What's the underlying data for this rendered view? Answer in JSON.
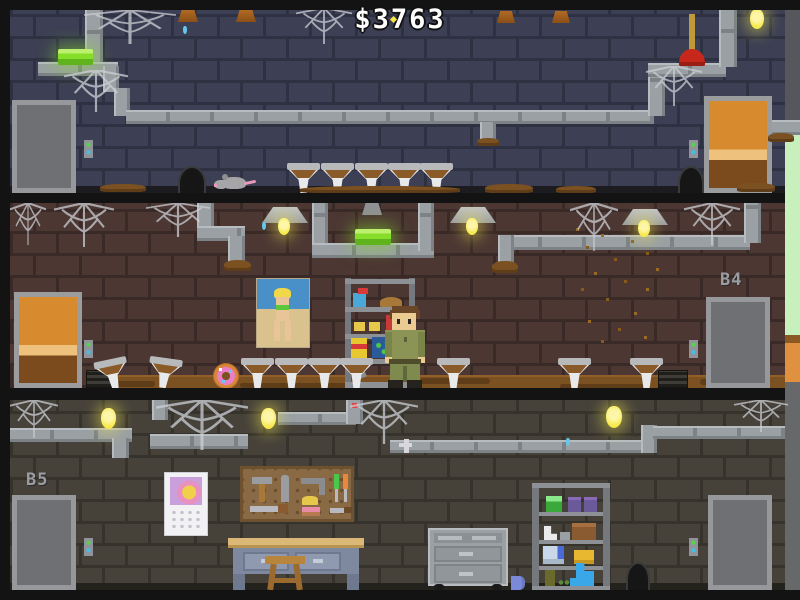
{
  "hud": {
    "money": "$3763"
  },
  "floors": {
    "top": {
      "label": "",
      "objects": [
        "elevator-doors",
        "call-button-panel",
        "green-tube-lamp",
        "pipe-network",
        "cobwebs",
        "dirty-sinks-x5",
        "rat",
        "mouse-hole-x2",
        "plunger",
        "ceiling-bulb",
        "wooden-door",
        "dirt-piles",
        "water-drip",
        "lamp-mounts"
      ]
    },
    "middle": {
      "label": "B4",
      "objects": [
        "wooden-door",
        "hanging-lamps-x3",
        "green-tube-lamp",
        "pipe-network",
        "cobwebs",
        "beach-poster",
        "supply-shelf",
        "spray-bottle",
        "straw-hat",
        "cleaning-bottle",
        "detergent-box",
        "janitor-character",
        "dirty-sinks-x7",
        "donut",
        "floor-grates",
        "fly-swarm",
        "elevator-doors",
        "call-button-panels",
        "leak-drips"
      ]
    },
    "bottom": {
      "label": "B5",
      "objects": [
        "elevator-doors-x2",
        "call-button-panels",
        "pipe-network",
        "cobwebs",
        "hanging-bulbs-x3",
        "calendar",
        "pegboard-tools",
        "hammer",
        "wrench",
        "screwdrivers",
        "saw",
        "workbench",
        "stool",
        "rolling-cabinet",
        "mug",
        "storage-shelf",
        "boots",
        "boxes",
        "mouse-hole",
        "water-drip"
      ]
    }
  },
  "colors": {
    "money_text": "#ffffff",
    "wall_top": "#3d4054",
    "wall_middle": "#4c3733",
    "wall_bottom": "#46423a",
    "green_lamp": "#86dd2a",
    "bulb_yellow": "#f7ea4a",
    "elevator_gray": "#b2b4b6",
    "door_orange": "#d78a2e",
    "call_green": "#57d24a",
    "call_blue": "#46bee0",
    "floor_dirt": "#7c5122",
    "outside_green": "#c8f0bd",
    "outside_orange": "#e0913f"
  }
}
